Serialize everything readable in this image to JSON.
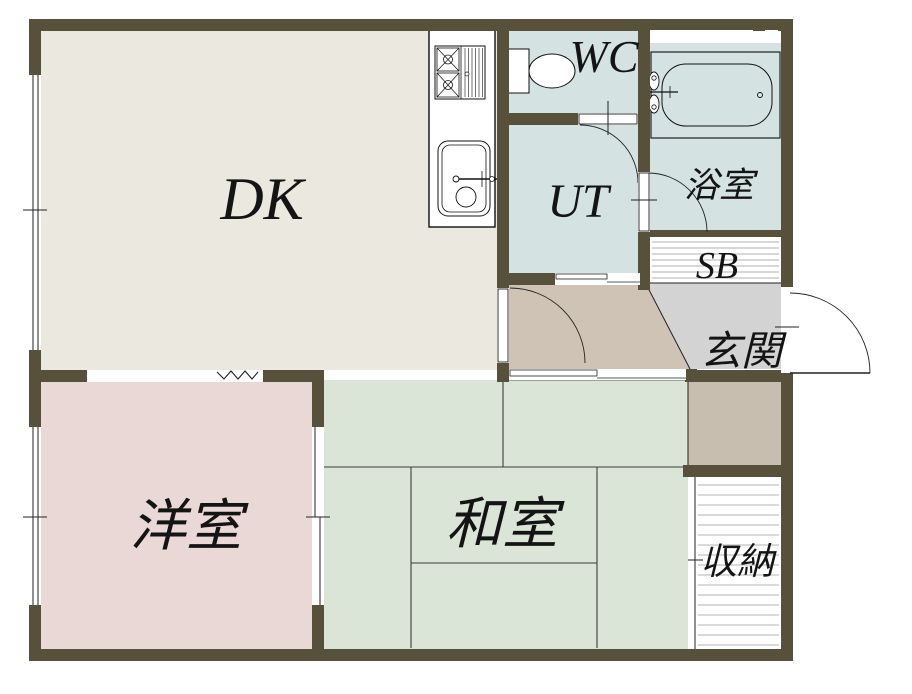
{
  "floorplan": {
    "rooms": {
      "dk": {
        "label": "DK"
      },
      "wc": {
        "label": "WC"
      },
      "ut": {
        "label": "UT"
      },
      "bath": {
        "label": "浴室"
      },
      "shoe_box": {
        "label": "SB"
      },
      "entrance": {
        "label": "玄関"
      },
      "western_room": {
        "label": "洋室"
      },
      "japanese_room": {
        "label": "和室"
      },
      "storage": {
        "label": "収納"
      }
    },
    "colors": {
      "wall": "#57503a",
      "dk_floor": "#ebe8e0",
      "wet_floor": "#d4e2e1",
      "hall_floor": "#cec3b5",
      "entrance_floor": "#d3d3d3",
      "side_floor": "#c8beb0",
      "western_room_floor": "#e9d8d5",
      "japanese_room_floor": "#dbe5d7",
      "storage_floor": "#ffffff"
    },
    "fixtures": [
      "stove-icon",
      "kitchen-sink-icon",
      "toilet-icon",
      "bathtub-icon"
    ]
  }
}
